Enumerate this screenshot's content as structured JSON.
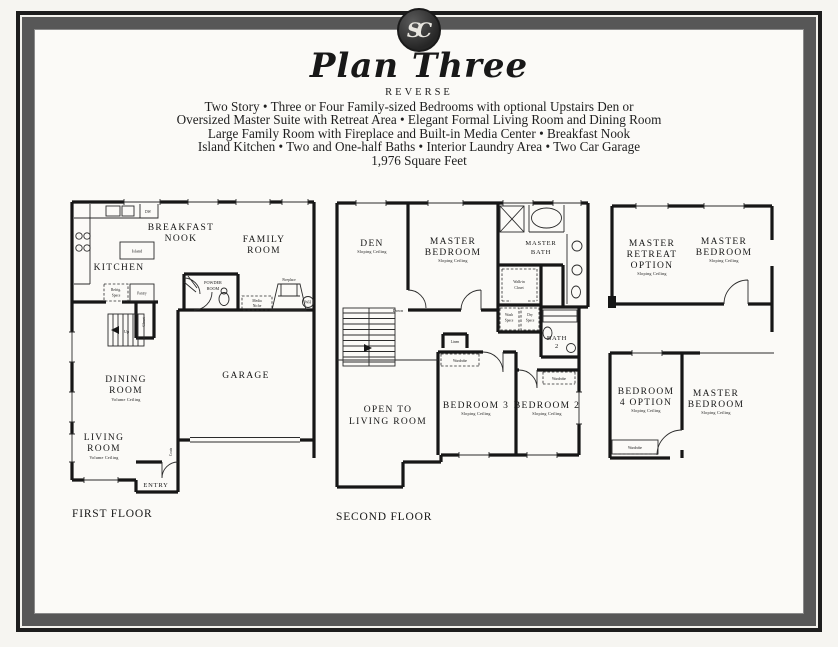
{
  "colors": {
    "paper": "#fbfaf7",
    "frame_black": "#1d1d1d",
    "frame_band": "#575757",
    "ink": "#1b1b1b"
  },
  "header": {
    "monogram": "SC",
    "title": "Plan Three",
    "subtitle": "REVERSE",
    "description_lines": [
      "Two Story • Three or Four Family-sized Bedrooms with optional Upstairs Den or",
      "Oversized Master Suite with Retreat Area • Elegant Formal Living Room and Dining Room",
      "Large Family Room with Fireplace and Built-in Media Center • Breakfast Nook",
      "Island Kitchen • Two and One-half Baths • Interior Laundry Area • Two Car Garage",
      "1,976 Square Feet"
    ]
  },
  "first_floor": {
    "caption": "FIRST FLOOR",
    "rooms": {
      "kitchen": "KITCHEN",
      "breakfast_nook_l1": "BREAKFAST",
      "breakfast_nook_l2": "NOOK",
      "family_l1": "FAMILY",
      "family_l2": "ROOM",
      "dining_l1": "DINING",
      "dining_l2": "ROOM",
      "dining_note": "Volume Ceiling",
      "living_l1": "LIVING",
      "living_l2": "ROOM",
      "living_note": "Volume Ceiling",
      "garage": "GARAGE",
      "entry": "ENTRY",
      "powder_l1": "POWDER",
      "powder_l2": "ROOM"
    },
    "fixtures": {
      "island": "Island",
      "dw": "DW",
      "refrig_l1": "Refrig.",
      "refrig_l2": "Space",
      "pantry": "Pantry",
      "closet": "Closet",
      "coats": "Coats",
      "up": "Up",
      "media_l1": "Media",
      "media_l2": "Niche",
      "fireplace": "Fireplace",
      "wh": "WH"
    }
  },
  "second_floor": {
    "caption": "SECOND FLOOR",
    "rooms": {
      "den": "DEN",
      "den_note": "Sloping Ceiling",
      "master_bedroom_l1": "MASTER",
      "master_bedroom_l2": "BEDROOM",
      "master_bedroom_note": "Sloping Ceiling",
      "master_bath_l1": "MASTER",
      "master_bath_l2": "BATH",
      "open_l1": "OPEN TO",
      "open_l2": "LIVING ROOM",
      "bedroom3": "BEDROOM 3",
      "bedroom3_note": "Sloping Ceiling",
      "bedroom2": "BEDROOM 2",
      "bedroom2_note": "Sloping Ceiling",
      "bath2_l1": "BATH",
      "bath2_l2": "2"
    },
    "fixtures": {
      "down": "Down",
      "walkin_l1": "Walk-in",
      "walkin_l2": "Closet",
      "wash_l1": "Wash",
      "wash_l2": "Space",
      "dry_l1": "Dry",
      "dry_l2": "Space",
      "linen": "Linen",
      "wardrobe_b3": "Wardrobe",
      "wardrobe_b2": "Wardrobe"
    }
  },
  "options": {
    "retreat": {
      "retreat_l1": "MASTER",
      "retreat_l2": "RETREAT",
      "retreat_l3": "OPTION",
      "retreat_note": "Sloping Ceiling",
      "bedroom_l1": "MASTER",
      "bedroom_l2": "BEDROOM",
      "bedroom_note": "Sloping Ceiling"
    },
    "bedroom4": {
      "b4_l1": "BEDROOM",
      "b4_l2": "4 OPTION",
      "b4_note": "Sloping Ceiling",
      "bedroom_l1": "MASTER",
      "bedroom_l2": "BEDROOM",
      "bedroom_note": "Sloping Ceiling",
      "wardrobe": "Wardrobe"
    }
  }
}
